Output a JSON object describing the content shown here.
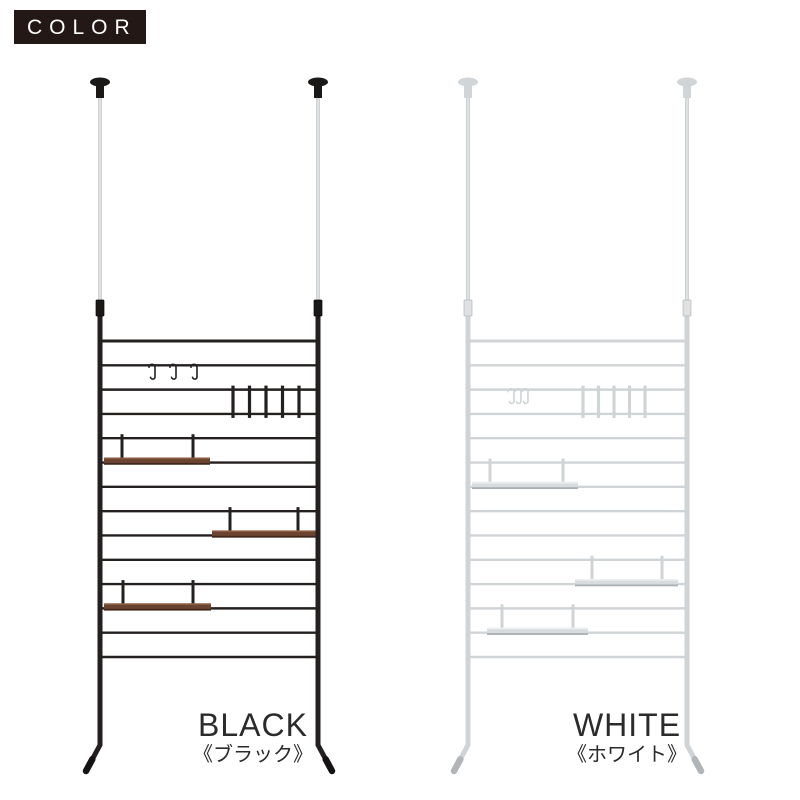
{
  "badge": {
    "label": "COLOR",
    "bg": "#231815",
    "fg": "#ffffff"
  },
  "text_color": "#2b2b2b",
  "products": [
    {
      "id": "black",
      "name": "BLACK",
      "name_jp": "《ブラック》",
      "colors": {
        "frame": "#23201f",
        "foot": "#141212",
        "cap": "#1b1918",
        "pole": "#c6cacc",
        "pole_highlight": "#eef0f0",
        "connector": "#1b1918",
        "connector_edge": "#0a0909",
        "shelf_board": "#6b4331",
        "shelf_board_top": "#8b5a3e",
        "shelf_board_edge": "#40281b"
      },
      "accessories": {
        "s_hooks": 3,
        "hook_panel_slats": 5,
        "shelves": 3
      }
    },
    {
      "id": "white",
      "name": "WHITE",
      "name_jp": "《ホワイト》",
      "colors": {
        "frame": "#d0d4d6",
        "foot": "#b1b5b8",
        "cap": "#d2d5d7",
        "pole": "#c3c7c9",
        "pole_highlight": "#f1f2f3",
        "connector": "#dfe1e2",
        "connector_edge": "#b3b8bb",
        "shelf_board": "#d8dcdf",
        "shelf_board_top": "#edeff0",
        "shelf_board_edge": "#a9afb3"
      },
      "accessories": {
        "s_hooks": 3,
        "hook_panel_slats": 5,
        "shelves": 3
      }
    }
  ]
}
